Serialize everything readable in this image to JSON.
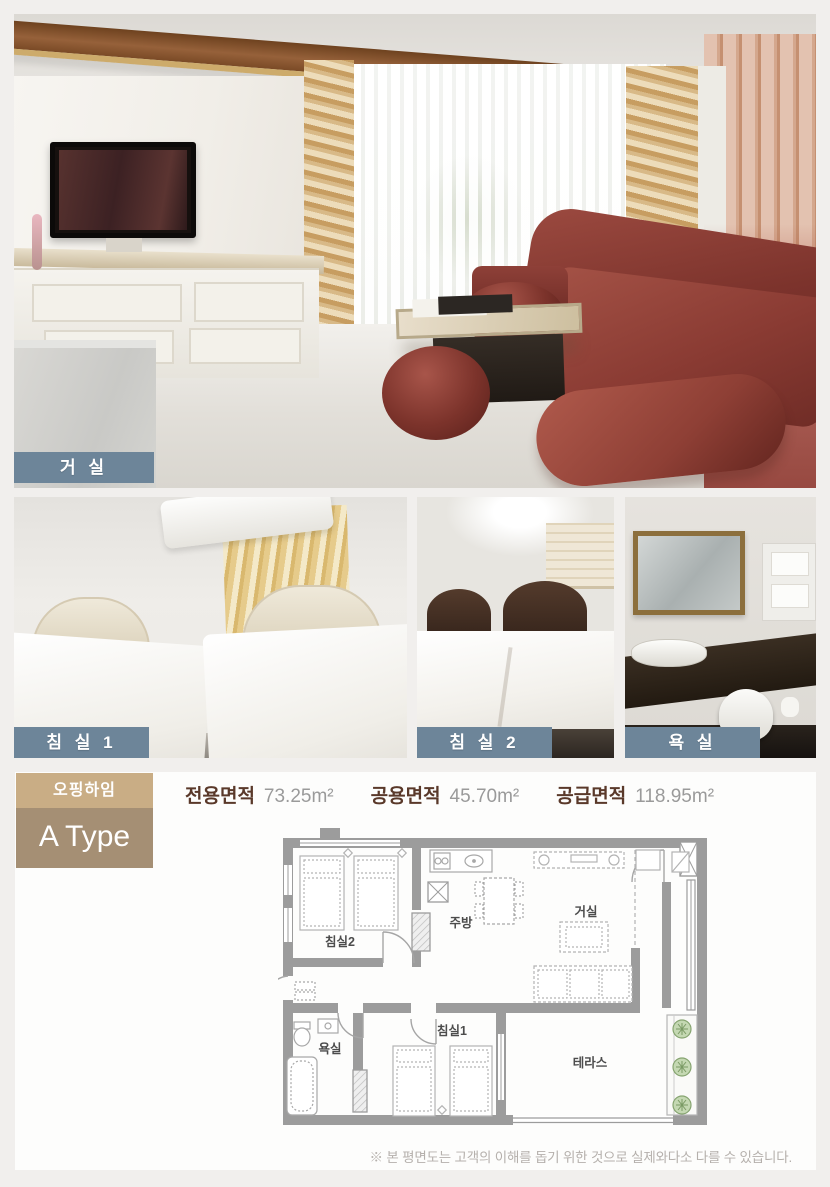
{
  "photos": {
    "living_room_label": "거 실",
    "bedroom1_label": "침 실 1",
    "bedroom2_label": "침 실 2",
    "bathroom_label": "욕 실"
  },
  "floorplan": {
    "badge_top": "오핑하임",
    "badge_bottom": "A Type",
    "areas": [
      {
        "label": "전용면적",
        "value": "73.25m²"
      },
      {
        "label": "공용면적",
        "value": "45.70m²"
      },
      {
        "label": "공급면적",
        "value": "118.95m²"
      }
    ],
    "rooms": {
      "bedroom2": "침실2",
      "kitchen": "주방",
      "living": "거실",
      "bathroom": "욕실",
      "bedroom1": "침실1",
      "terrace": "테라스"
    },
    "disclaimer": "※ 본 평면도는 고객의 이해를 돕기 위한 것으로 실제와다소 다를 수 있습니다."
  },
  "colors": {
    "page_background": "#f1efed",
    "photo_label_background": "#6d8599",
    "badge_top_background": "#c9ad85",
    "badge_bottom_background": "#a58f74",
    "area_label_text": "#5a392a",
    "area_value_text": "#9a9a9a",
    "plan_wall": "#9c9c9c"
  }
}
